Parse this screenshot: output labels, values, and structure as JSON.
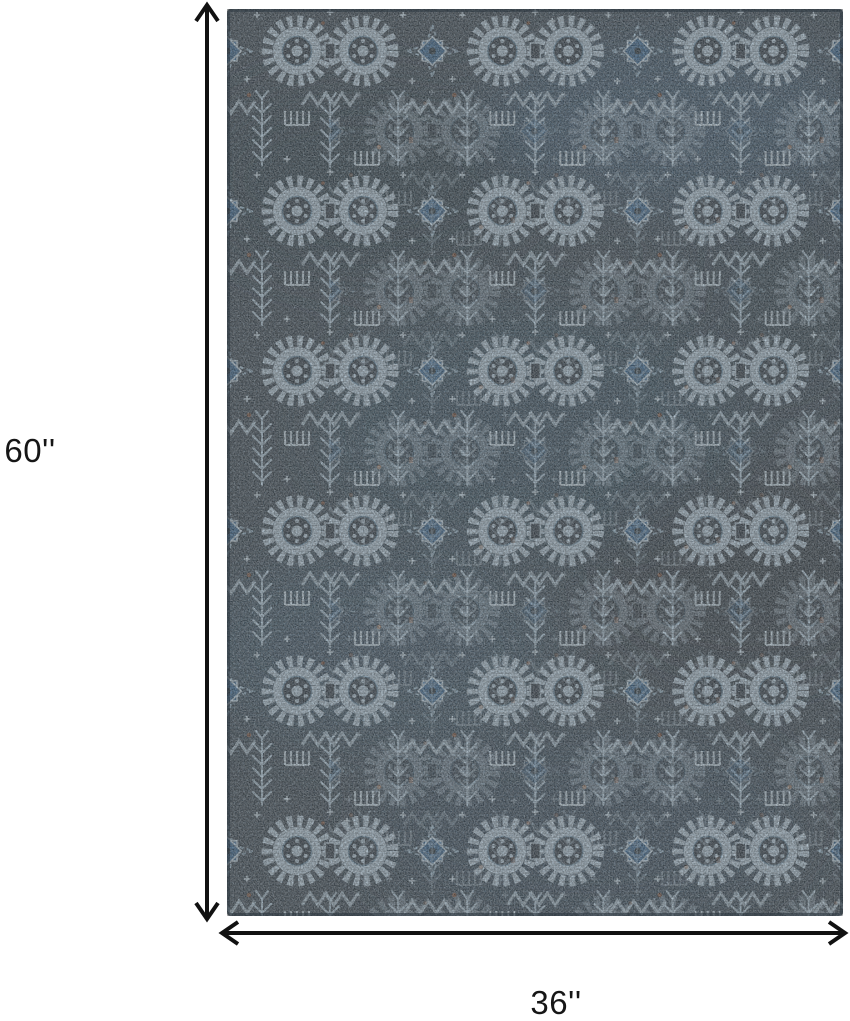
{
  "diagram": {
    "alt": "Blue tribal patterned area rug shown with dimension arrows",
    "height_label": "60''",
    "width_label": "36''",
    "arrow_color": "#111111"
  },
  "rug": {
    "colors": {
      "base": "#42505b",
      "dark": "#333e47",
      "blue": "#3f6b93",
      "steel": "#6e96b2",
      "pale": "#b5cbda",
      "light": "#cfdfe9",
      "rust": "#7d5642"
    }
  }
}
